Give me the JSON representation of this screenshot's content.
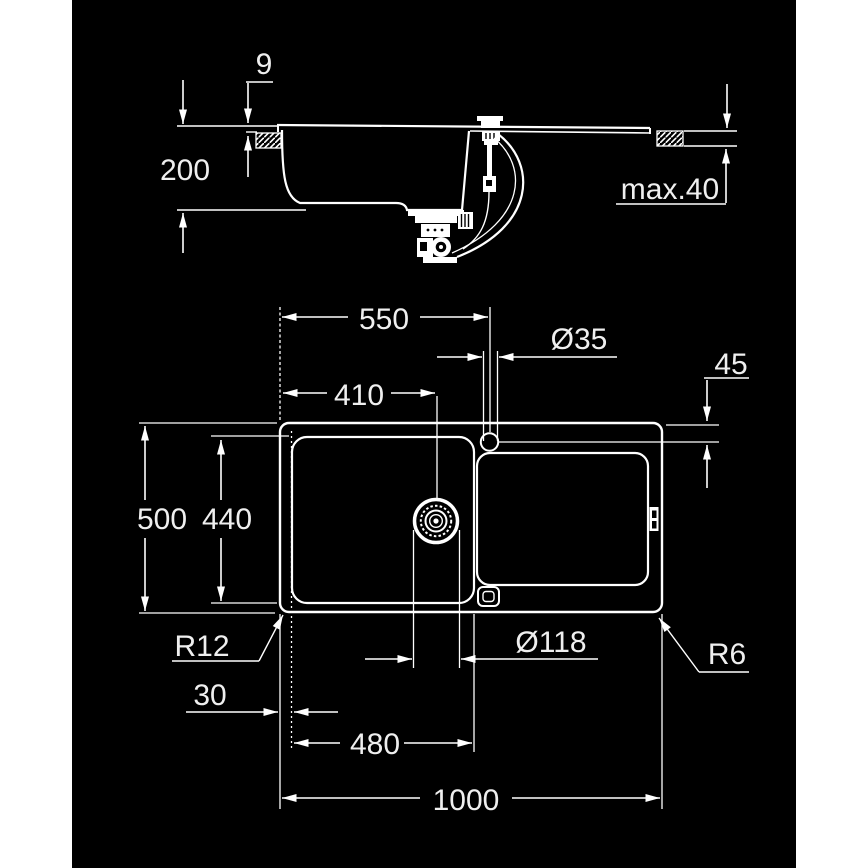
{
  "drawing": {
    "product": "kitchen-sink-dimension-drawing",
    "colors": {
      "canvas": "#000000",
      "margin": "#ffffff",
      "line": "#ffffff",
      "label": "#efefef"
    },
    "section": {
      "rim_height": "9",
      "bowl_depth": "200",
      "worktop_thickness": "max.40"
    },
    "plan": {
      "tap_from_left": "550",
      "tap_hole_dia": "Ø35",
      "tap_from_edge": "45",
      "drain_from_left": "410",
      "overall_width": "500",
      "bowl_width": "440",
      "bowl_corner_radius": "R12",
      "bowl_offset_left": "30",
      "bowl_length": "480",
      "drain_dia": "Ø118",
      "outer_corner_radius": "R6",
      "overall_length": "1000"
    }
  }
}
